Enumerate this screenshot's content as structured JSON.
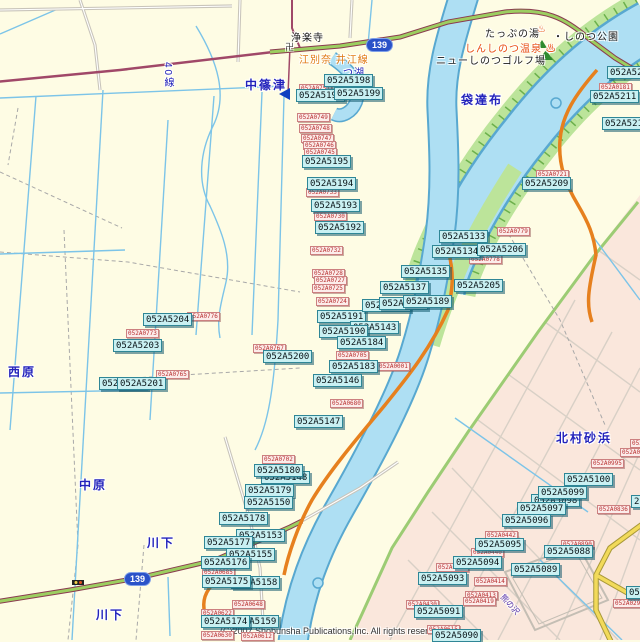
{
  "map": {
    "copyright": "(C)2007 Shobunsha Publications,Inc. All rights reserved.",
    "colors": {
      "background": "#FEFCE4",
      "urban_area": "#FAE7DC",
      "river": "#AEDFF3",
      "river_edge": "#58A8D0",
      "bank_green": "#BCE49A",
      "road_orange": "#E6801E",
      "road_green": "#9CCE60",
      "road_maroon": "#A04868",
      "road_yellow": "#F2DA5A",
      "code_label_bg": "#C9F0F2",
      "code_label_border": "#2F8696",
      "small_label_text": "#B83030",
      "place_text": "#2323BB"
    },
    "route_shields": [
      {
        "n": "139",
        "x": 366,
        "y": 38
      },
      {
        "n": "139",
        "x": 124,
        "y": 572
      }
    ],
    "texts": [
      {
        "t": "中篠津",
        "x": 245,
        "y": 76,
        "c": "place"
      },
      {
        "t": "袋達布",
        "x": 461,
        "y": 91,
        "c": "place"
      },
      {
        "t": "西原",
        "x": 8,
        "y": 363,
        "c": "place"
      },
      {
        "t": "中原",
        "x": 79,
        "y": 476,
        "c": "place"
      },
      {
        "t": "川下",
        "x": 147,
        "y": 534,
        "c": "place"
      },
      {
        "t": "川下",
        "x": 96,
        "y": 606,
        "c": "place"
      },
      {
        "t": "北村砂浜",
        "x": 556,
        "y": 429,
        "c": "place"
      },
      {
        "t": "つ湖",
        "x": 343,
        "y": 64,
        "c": "lake"
      },
      {
        "t": "40線",
        "x": 160,
        "y": 62,
        "c": "vert"
      },
      {
        "t": "浄楽寺",
        "x": 291,
        "y": 29,
        "c": "poi"
      },
      {
        "t": "卍",
        "x": 285,
        "y": 40,
        "c": "temple"
      },
      {
        "t": "江別奈 井江線",
        "x": 299,
        "y": 51,
        "c": "road"
      },
      {
        "t": "たっぷの湯",
        "x": 485,
        "y": 25,
        "c": "poi"
      },
      {
        "t": "♨",
        "x": 537,
        "y": 24,
        "c": "onsen"
      },
      {
        "t": "・しのつ公園",
        "x": 553,
        "y": 28,
        "c": "poi"
      },
      {
        "t": "しんしのつ温泉 ♨",
        "x": 465,
        "y": 40,
        "c": "onsen"
      },
      {
        "t": "ニューしのつゴルフ場",
        "x": 436,
        "y": 52,
        "c": "poi"
      },
      {
        "t": "熊の沢",
        "x": 506,
        "y": 592,
        "c": "rot"
      },
      {
        "t": "(C)2007 Shobunsha Publications,Inc. All rights reserved.",
        "x": 220,
        "y": 626,
        "c": "copy"
      }
    ],
    "cyan_labels": [
      {
        "t": "052A5198",
        "x": 324,
        "y": 74
      },
      {
        "t": "052A5197",
        "x": 296,
        "y": 89
      },
      {
        "t": "052A5199",
        "x": 334,
        "y": 87
      },
      {
        "t": "052A5195",
        "x": 302,
        "y": 155
      },
      {
        "t": "052A5194",
        "x": 307,
        "y": 177
      },
      {
        "t": "052A5193",
        "x": 311,
        "y": 199
      },
      {
        "t": "052A5192",
        "x": 315,
        "y": 221
      },
      {
        "t": "052A5191",
        "x": 317,
        "y": 310
      },
      {
        "t": "052A5143",
        "x": 350,
        "y": 321
      },
      {
        "t": "052A5190",
        "x": 319,
        "y": 325
      },
      {
        "t": "052A5184",
        "x": 337,
        "y": 336
      },
      {
        "t": "052A5183",
        "x": 329,
        "y": 360
      },
      {
        "t": "052A5146",
        "x": 313,
        "y": 374
      },
      {
        "t": "052A5147",
        "x": 294,
        "y": 415
      },
      {
        "t": "052A5204",
        "x": 143,
        "y": 313
      },
      {
        "t": "052A5203",
        "x": 113,
        "y": 339
      },
      {
        "t": "052A5202",
        "x": 99,
        "y": 377
      },
      {
        "t": "052A5201",
        "x": 117,
        "y": 377
      },
      {
        "t": "052A5200",
        "x": 263,
        "y": 350
      },
      {
        "t": "052A5148",
        "x": 261,
        "y": 471
      },
      {
        "t": "052A5180",
        "x": 254,
        "y": 464
      },
      {
        "t": "052A5179",
        "x": 245,
        "y": 484
      },
      {
        "t": "052A5150",
        "x": 244,
        "y": 496
      },
      {
        "t": "052A5178",
        "x": 219,
        "y": 512
      },
      {
        "t": "052A5153",
        "x": 236,
        "y": 529
      },
      {
        "t": "052A5177",
        "x": 204,
        "y": 536
      },
      {
        "t": "052A5155",
        "x": 226,
        "y": 548
      },
      {
        "t": "052A5176",
        "x": 201,
        "y": 556
      },
      {
        "t": "052A5158",
        "x": 231,
        "y": 576
      },
      {
        "t": "052A5175",
        "x": 202,
        "y": 575
      },
      {
        "t": "052A5159",
        "x": 230,
        "y": 615
      },
      {
        "t": "052A5174",
        "x": 201,
        "y": 615
      },
      {
        "t": "052A5133",
        "x": 439,
        "y": 230
      },
      {
        "t": "052A5134",
        "x": 432,
        "y": 245
      },
      {
        "t": "052A5206",
        "x": 477,
        "y": 243
      },
      {
        "t": "052A5135",
        "x": 401,
        "y": 265
      },
      {
        "t": "052A5137",
        "x": 380,
        "y": 281
      },
      {
        "t": "052A5205",
        "x": 454,
        "y": 279
      },
      {
        "t": "052A5136",
        "x": 362,
        "y": 299
      },
      {
        "t": "052A5138",
        "x": 379,
        "y": 297
      },
      {
        "t": "052A5189",
        "x": 403,
        "y": 295
      },
      {
        "t": "052A5212",
        "x": 607,
        "y": 66
      },
      {
        "t": "052A5211",
        "x": 590,
        "y": 90
      },
      {
        "t": "052A5210",
        "x": 602,
        "y": 117
      },
      {
        "t": "052A5209",
        "x": 522,
        "y": 177
      },
      {
        "t": "052A5100",
        "x": 564,
        "y": 473
      },
      {
        "t": "052A5098",
        "x": 531,
        "y": 494
      },
      {
        "t": "052A5099",
        "x": 538,
        "y": 486
      },
      {
        "t": "052A5097",
        "x": 517,
        "y": 502
      },
      {
        "t": "052A5096",
        "x": 502,
        "y": 514
      },
      {
        "t": "052A5095",
        "x": 475,
        "y": 538
      },
      {
        "t": "052A5094",
        "x": 453,
        "y": 556
      },
      {
        "t": "052A5093",
        "x": 418,
        "y": 572
      },
      {
        "t": "052A5091",
        "x": 414,
        "y": 605
      },
      {
        "t": "052A5090",
        "x": 432,
        "y": 629
      },
      {
        "t": "052A5088",
        "x": 544,
        "y": 545
      },
      {
        "t": "052A5089",
        "x": 511,
        "y": 563
      },
      {
        "t": "052A5087",
        "x": 626,
        "y": 586
      },
      {
        "t": "2",
        "x": 631,
        "y": 495
      }
    ],
    "pink_labels": [
      {
        "t": "052A0751",
        "x": 299,
        "y": 84
      },
      {
        "t": "052A0749",
        "x": 297,
        "y": 113
      },
      {
        "t": "052A0748",
        "x": 299,
        "y": 124
      },
      {
        "t": "052A0747",
        "x": 301,
        "y": 134
      },
      {
        "t": "052A0746",
        "x": 303,
        "y": 141
      },
      {
        "t": "052A0745",
        "x": 304,
        "y": 148
      },
      {
        "t": "052A0733",
        "x": 306,
        "y": 188
      },
      {
        "t": "052A0730",
        "x": 314,
        "y": 212
      },
      {
        "t": "052A0732",
        "x": 310,
        "y": 246
      },
      {
        "t": "052A0728",
        "x": 312,
        "y": 269
      },
      {
        "t": "052A0727",
        "x": 314,
        "y": 276
      },
      {
        "t": "052A0725",
        "x": 312,
        "y": 284
      },
      {
        "t": "052A0724",
        "x": 316,
        "y": 297
      },
      {
        "t": "052A0705",
        "x": 336,
        "y": 351
      },
      {
        "t": "052A0001",
        "x": 377,
        "y": 362
      },
      {
        "t": "052A0680",
        "x": 330,
        "y": 399
      },
      {
        "t": "052A0702",
        "x": 262,
        "y": 455
      },
      {
        "t": "052A0776",
        "x": 187,
        "y": 312
      },
      {
        "t": "052A0773",
        "x": 126,
        "y": 329
      },
      {
        "t": "052A0767",
        "x": 253,
        "y": 344
      },
      {
        "t": "052A0765",
        "x": 156,
        "y": 370
      },
      {
        "t": "052A0779",
        "x": 497,
        "y": 227
      },
      {
        "t": "052A0778",
        "x": 469,
        "y": 255
      },
      {
        "t": "052A0721",
        "x": 536,
        "y": 170
      },
      {
        "t": "052A0181",
        "x": 599,
        "y": 83
      },
      {
        "t": "052A0998",
        "x": 630,
        "y": 439
      },
      {
        "t": "052A0996",
        "x": 620,
        "y": 448
      },
      {
        "t": "052A0995",
        "x": 591,
        "y": 459
      },
      {
        "t": "052A0836",
        "x": 597,
        "y": 505
      },
      {
        "t": "052A0890",
        "x": 561,
        "y": 540
      },
      {
        "t": "052A0442",
        "x": 485,
        "y": 531
      },
      {
        "t": "052A0440",
        "x": 471,
        "y": 548
      },
      {
        "t": "052A0444",
        "x": 436,
        "y": 563
      },
      {
        "t": "052A0414",
        "x": 474,
        "y": 577
      },
      {
        "t": "052A0413",
        "x": 465,
        "y": 591
      },
      {
        "t": "052A0419",
        "x": 463,
        "y": 597
      },
      {
        "t": "052A0430",
        "x": 406,
        "y": 600
      },
      {
        "t": "052A0615",
        "x": 427,
        "y": 625
      },
      {
        "t": "052A0290",
        "x": 613,
        "y": 599
      },
      {
        "t": "052A0648",
        "x": 232,
        "y": 600
      },
      {
        "t": "052A0622",
        "x": 201,
        "y": 609
      },
      {
        "t": "052A0685",
        "x": 202,
        "y": 568
      },
      {
        "t": "052A0630",
        "x": 201,
        "y": 631
      },
      {
        "t": "052A0612",
        "x": 241,
        "y": 632
      }
    ]
  }
}
